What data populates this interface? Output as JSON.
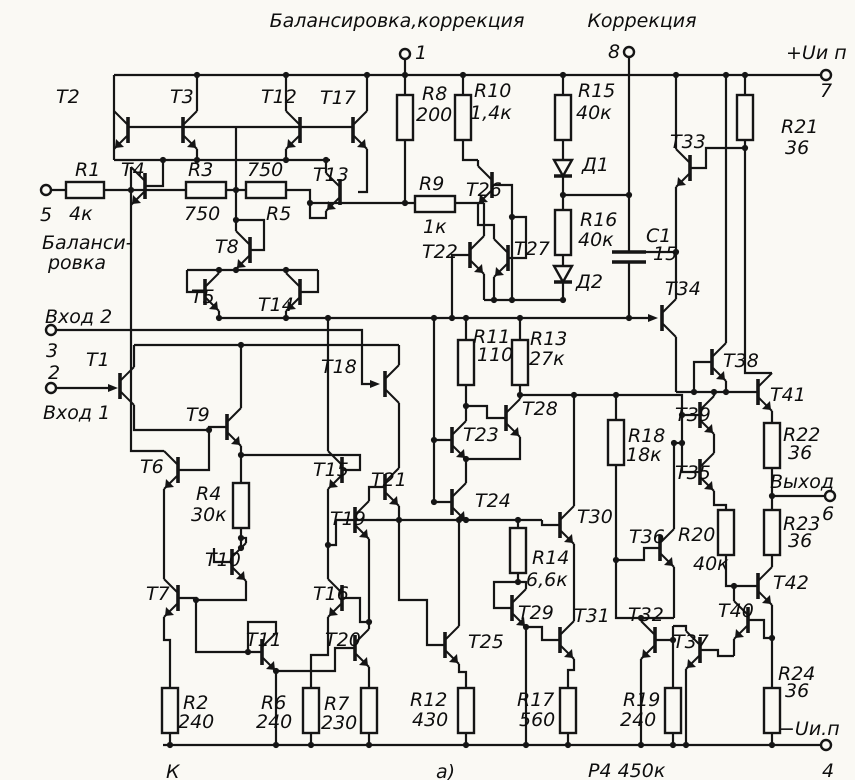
{
  "schematic": {
    "headers": [
      {
        "t": "Балансировка,коррекция",
        "x": 397,
        "y": 27,
        "a": "middle"
      },
      {
        "t": "Коррекция",
        "x": 642,
        "y": 27,
        "a": "middle"
      },
      {
        "t": "+Uи п",
        "x": 786,
        "y": 59,
        "a": "start"
      },
      {
        "t": "−Uи.п",
        "x": 779,
        "y": 735,
        "a": "start"
      }
    ],
    "labels": [
      {
        "t": "1",
        "x": 415,
        "y": 59
      },
      {
        "t": "8",
        "x": 608,
        "y": 58
      },
      {
        "t": "7",
        "x": 826,
        "y": 97,
        "a": "middle"
      },
      {
        "t": "5",
        "x": 46,
        "y": 221,
        "a": "middle"
      },
      {
        "t": "Баланси-",
        "x": 42,
        "y": 249
      },
      {
        "t": "ровка",
        "x": 48,
        "y": 269
      },
      {
        "t": "Вход 2",
        "x": 45,
        "y": 323
      },
      {
        "t": "3",
        "x": 52,
        "y": 357,
        "a": "middle"
      },
      {
        "t": "2",
        "x": 54,
        "y": 379,
        "a": "middle"
      },
      {
        "t": "Вход 1",
        "x": 43,
        "y": 419
      },
      {
        "t": "Выход",
        "x": 770,
        "y": 488
      },
      {
        "t": "6",
        "x": 828,
        "y": 520,
        "a": "middle"
      },
      {
        "t": "4",
        "x": 828,
        "y": 777,
        "a": "middle"
      },
      {
        "t": "а)",
        "x": 436,
        "y": 778
      },
      {
        "t": "К",
        "x": 166,
        "y": 778
      },
      {
        "t": "Р4 450к",
        "x": 588,
        "y": 777
      }
    ],
    "terminals": [
      {
        "pin": "1",
        "x": 405,
        "y": 54
      },
      {
        "pin": "8",
        "x": 629,
        "y": 52
      },
      {
        "pin": "7",
        "x": 826,
        "y": 75
      },
      {
        "pin": "5",
        "x": 46,
        "y": 190
      },
      {
        "pin": "3",
        "x": 51,
        "y": 330
      },
      {
        "pin": "2",
        "x": 51,
        "y": 388
      },
      {
        "pin": "6",
        "x": 830,
        "y": 496
      },
      {
        "pin": "4",
        "x": 826,
        "y": 745
      }
    ],
    "transistors": [
      {
        "name": "T1",
        "x": 120,
        "y": 386,
        "s": 1,
        "fet": true,
        "lx": 86,
        "ly": 366
      },
      {
        "name": "T2",
        "x": 128,
        "y": 130,
        "s": -1,
        "lx": 56,
        "ly": 103
      },
      {
        "name": "T3",
        "x": 183,
        "y": 130,
        "s": 1,
        "lx": 170,
        "ly": 103
      },
      {
        "name": "T4",
        "x": 145,
        "y": 186,
        "s": -1,
        "lx": 121,
        "ly": 176
      },
      {
        "name": "T5",
        "x": 205,
        "y": 292,
        "s": 1,
        "lx": 191,
        "ly": 303
      },
      {
        "name": "T6",
        "x": 178,
        "y": 470,
        "s": -1,
        "lx": 140,
        "ly": 473
      },
      {
        "name": "T7",
        "x": 178,
        "y": 598,
        "s": -1,
        "lx": 146,
        "ly": 600
      },
      {
        "name": "T8",
        "x": 250,
        "y": 250,
        "s": -1,
        "lx": 215,
        "ly": 253
      },
      {
        "name": "T9",
        "x": 227,
        "y": 427,
        "s": 1,
        "lx": 186,
        "ly": 421
      },
      {
        "name": "T10",
        "x": 232,
        "y": 562,
        "s": 1,
        "lx": 205,
        "ly": 566
      },
      {
        "name": "T11",
        "x": 262,
        "y": 652,
        "s": 1,
        "lx": 246,
        "ly": 646
      },
      {
        "name": "T12",
        "x": 300,
        "y": 130,
        "s": -1,
        "lx": 261,
        "ly": 103
      },
      {
        "name": "T13",
        "x": 340,
        "y": 192,
        "s": -1,
        "lx": 313,
        "ly": 181
      },
      {
        "name": "T14",
        "x": 300,
        "y": 292,
        "s": -1,
        "lx": 258,
        "ly": 311
      },
      {
        "name": "T15",
        "x": 342,
        "y": 470,
        "s": -1,
        "lx": 313,
        "ly": 476
      },
      {
        "name": "T16",
        "x": 342,
        "y": 598,
        "s": -1,
        "lx": 313,
        "ly": 600
      },
      {
        "name": "T17",
        "x": 353,
        "y": 130,
        "s": 1,
        "lx": 320,
        "ly": 104
      },
      {
        "name": "T18",
        "x": 385,
        "y": 384,
        "s": 1,
        "fet": true,
        "lx": 321,
        "ly": 373
      },
      {
        "name": "T19",
        "x": 355,
        "y": 520,
        "s": 1,
        "lx": 330,
        "ly": 525
      },
      {
        "name": "T20",
        "x": 355,
        "y": 648,
        "s": 1,
        "lx": 325,
        "ly": 646
      },
      {
        "name": "T21",
        "x": 385,
        "y": 487,
        "s": 1,
        "lx": 371,
        "ly": 486
      },
      {
        "name": "T22",
        "x": 470,
        "y": 255,
        "s": 1,
        "lx": 422,
        "ly": 258
      },
      {
        "name": "T23",
        "x": 452,
        "y": 440,
        "s": 1,
        "lx": 463,
        "ly": 441
      },
      {
        "name": "T24",
        "x": 452,
        "y": 502,
        "s": 1,
        "lx": 475,
        "ly": 507
      },
      {
        "name": "T25",
        "x": 445,
        "y": 645,
        "s": 1,
        "lx": 468,
        "ly": 648
      },
      {
        "name": "T26",
        "x": 492,
        "y": 185,
        "s": -1,
        "lx": 466,
        "ly": 196
      },
      {
        "name": "T27",
        "x": 508,
        "y": 258,
        "s": -1,
        "lx": 514,
        "ly": 255
      },
      {
        "name": "T28",
        "x": 506,
        "y": 418,
        "s": 1,
        "lx": 522,
        "ly": 415
      },
      {
        "name": "T29",
        "x": 512,
        "y": 608,
        "s": 1,
        "lx": 518,
        "ly": 619
      },
      {
        "name": "T30",
        "x": 560,
        "y": 525,
        "s": 1,
        "lx": 577,
        "ly": 523
      },
      {
        "name": "T31",
        "x": 560,
        "y": 640,
        "s": 1,
        "lx": 574,
        "ly": 622
      },
      {
        "name": "T32",
        "x": 655,
        "y": 640,
        "s": -1,
        "lx": 628,
        "ly": 621
      },
      {
        "name": "T33",
        "x": 690,
        "y": 168,
        "s": -1,
        "lx": 670,
        "ly": 148
      },
      {
        "name": "T34",
        "x": 662,
        "y": 318,
        "s": 1,
        "fet": true,
        "lx": 665,
        "ly": 295
      },
      {
        "name": "T35",
        "x": 700,
        "y": 472,
        "s": 1,
        "lx": 675,
        "ly": 479
      },
      {
        "name": "T36",
        "x": 660,
        "y": 548,
        "s": 1,
        "lx": 629,
        "ly": 543
      },
      {
        "name": "T37",
        "x": 700,
        "y": 650,
        "s": -1,
        "lx": 673,
        "ly": 648
      },
      {
        "name": "T38",
        "x": 712,
        "y": 362,
        "s": 1,
        "lx": 723,
        "ly": 367
      },
      {
        "name": "T39",
        "x": 700,
        "y": 415,
        "s": 1,
        "lx": 675,
        "ly": 421
      },
      {
        "name": "T40",
        "x": 748,
        "y": 620,
        "s": -1,
        "lx": 718,
        "ly": 617
      },
      {
        "name": "T41",
        "x": 758,
        "y": 392,
        "s": 1,
        "lx": 770,
        "ly": 401
      },
      {
        "name": "T42",
        "x": 758,
        "y": 586,
        "s": 1,
        "lx": 773,
        "ly": 589
      }
    ],
    "resistors": [
      {
        "name": "R1",
        "value": "4к",
        "x": 66,
        "y": 182,
        "w": 38,
        "h": 16,
        "l1": [
          75,
          176
        ],
        "l2": [
          69,
          220
        ]
      },
      {
        "name": "R2",
        "value": "240",
        "x": 162,
        "y": 688,
        "w": 16,
        "h": 45,
        "l1": [
          183,
          709
        ],
        "l2": [
          178,
          728
        ]
      },
      {
        "name": "R3",
        "value": "750",
        "x": 186,
        "y": 182,
        "w": 40,
        "h": 16,
        "l1": [
          188,
          176
        ],
        "l2": [
          184,
          220
        ]
      },
      {
        "name": "R4",
        "value": "30к",
        "x": 233,
        "y": 483,
        "w": 16,
        "h": 45,
        "l1": [
          196,
          500
        ],
        "l2": [
          191,
          521
        ]
      },
      {
        "name": "R5",
        "value": "750",
        "x": 246,
        "y": 182,
        "w": 40,
        "h": 16,
        "l1": [
          266,
          220
        ],
        "l2": [
          247,
          176
        ]
      },
      {
        "name": "R6",
        "value": "240",
        "x": 303,
        "y": 688,
        "w": 16,
        "h": 45,
        "l1": [
          261,
          709
        ],
        "l2": [
          256,
          728
        ]
      },
      {
        "name": "R7",
        "value": "230",
        "x": 361,
        "y": 688,
        "w": 16,
        "h": 45,
        "l1": [
          324,
          710
        ],
        "l2": [
          321,
          729
        ]
      },
      {
        "name": "R8",
        "value": "200",
        "x": 397,
        "y": 95,
        "w": 16,
        "h": 45,
        "l1": [
          422,
          100
        ],
        "l2": [
          416,
          121
        ]
      },
      {
        "name": "R9",
        "value": "1к",
        "x": 415,
        "y": 196,
        "w": 40,
        "h": 16,
        "l1": [
          419,
          190
        ],
        "l2": [
          423,
          233
        ]
      },
      {
        "name": "R10",
        "value": "1,4к",
        "x": 455,
        "y": 95,
        "w": 16,
        "h": 45,
        "l1": [
          474,
          97
        ],
        "l2": [
          470,
          119
        ]
      },
      {
        "name": "R11",
        "value": "110",
        "x": 458,
        "y": 340,
        "w": 16,
        "h": 45,
        "l1": [
          473,
          343
        ],
        "l2": [
          477,
          361
        ]
      },
      {
        "name": "R12",
        "value": "430",
        "x": 458,
        "y": 688,
        "w": 16,
        "h": 45,
        "l1": [
          410,
          706
        ],
        "l2": [
          412,
          726
        ]
      },
      {
        "name": "R13",
        "value": "27к",
        "x": 512,
        "y": 340,
        "w": 16,
        "h": 45,
        "l1": [
          530,
          345
        ],
        "l2": [
          529,
          365
        ]
      },
      {
        "name": "R14",
        "value": "6,6к",
        "x": 510,
        "y": 528,
        "w": 16,
        "h": 45,
        "l1": [
          532,
          564
        ],
        "l2": [
          526,
          586
        ]
      },
      {
        "name": "R15",
        "value": "40к",
        "x": 555,
        "y": 95,
        "w": 16,
        "h": 45,
        "l1": [
          578,
          97
        ],
        "l2": [
          576,
          119
        ]
      },
      {
        "name": "R16",
        "value": "40к",
        "x": 555,
        "y": 210,
        "w": 16,
        "h": 45,
        "l1": [
          580,
          226
        ],
        "l2": [
          578,
          246
        ]
      },
      {
        "name": "R17",
        "value": "560",
        "x": 560,
        "y": 688,
        "w": 16,
        "h": 45,
        "l1": [
          517,
          706
        ],
        "l2": [
          519,
          726
        ]
      },
      {
        "name": "R18",
        "value": "18к",
        "x": 608,
        "y": 420,
        "w": 16,
        "h": 45,
        "l1": [
          628,
          442
        ],
        "l2": [
          626,
          461
        ]
      },
      {
        "name": "R19",
        "value": "240",
        "x": 665,
        "y": 688,
        "w": 16,
        "h": 45,
        "l1": [
          623,
          706
        ],
        "l2": [
          620,
          726
        ]
      },
      {
        "name": "R20",
        "value": "40к",
        "x": 718,
        "y": 510,
        "w": 16,
        "h": 45,
        "l1": [
          678,
          541
        ],
        "l2": [
          693,
          570
        ]
      },
      {
        "name": "R21",
        "value": "36",
        "x": 737,
        "y": 95,
        "w": 16,
        "h": 45,
        "l1": [
          781,
          133
        ],
        "l2": [
          785,
          154
        ]
      },
      {
        "name": "R22",
        "value": "36",
        "x": 764,
        "y": 423,
        "w": 16,
        "h": 45,
        "l1": [
          783,
          441
        ],
        "l2": [
          788,
          459
        ]
      },
      {
        "name": "R23",
        "value": "36",
        "x": 764,
        "y": 510,
        "w": 16,
        "h": 45,
        "l1": [
          783,
          530
        ],
        "l2": [
          788,
          547
        ]
      },
      {
        "name": "R24",
        "value": "36",
        "x": 764,
        "y": 688,
        "w": 16,
        "h": 45,
        "l1": [
          778,
          680
        ],
        "l2": [
          785,
          697
        ]
      }
    ],
    "diodes": [
      {
        "name": "Д1",
        "x": 563,
        "y": 160,
        "l": [
          582,
          171
        ]
      },
      {
        "name": "Д2",
        "x": 563,
        "y": 266,
        "l": [
          576,
          288
        ]
      }
    ],
    "capacitors": [
      {
        "name": "C1",
        "value": "15",
        "x": 629,
        "y1": 252,
        "y2": 262,
        "half": 17,
        "l1": [
          646,
          242
        ],
        "l2": [
          653,
          260
        ]
      }
    ]
  }
}
